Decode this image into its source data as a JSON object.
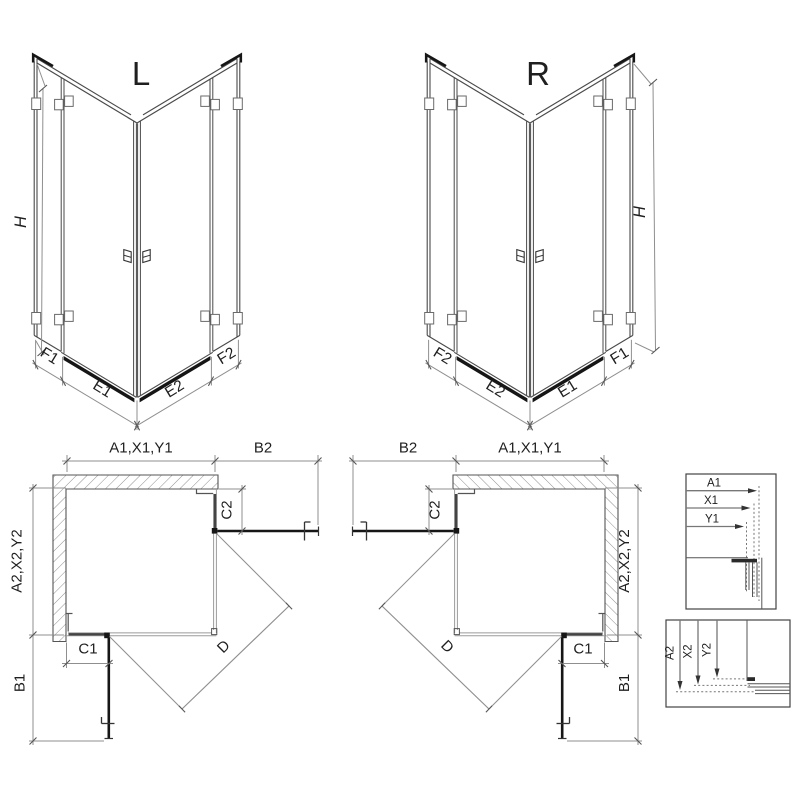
{
  "drawing": {
    "background": "#ffffff",
    "main_line_color": "#4a4a4a",
    "dim_line_color": "#8f8f8f",
    "dark_profile_color": "#161616"
  },
  "iso_left": {
    "title": "L",
    "height": "H",
    "panel_left": "F1",
    "door_left": "E1",
    "door_right": "E2",
    "panel_right": "F2"
  },
  "iso_right": {
    "title": "R",
    "height": "H",
    "panel_left": "F2",
    "door_left": "E2",
    "door_right": "E1",
    "panel_right": "F1"
  },
  "plan_left": {
    "width_top": "A1,X1,Y1",
    "door_open_side": "B2",
    "fixed_side": "C2",
    "depth_side": "A2,X2,Y2",
    "fixed_front": "C1",
    "door_open_front": "B1",
    "diagonal": "D"
  },
  "plan_right": {
    "width_top": "A1,X1,Y1",
    "door_open_side": "B2",
    "fixed_side": "C2",
    "depth_side": "A2,X2,Y2",
    "fixed_front": "C1",
    "door_open_front": "B1",
    "diagonal": "D"
  },
  "detail_width": {
    "rows": [
      {
        "label": "A1"
      },
      {
        "label": "X1"
      },
      {
        "label": "Y1"
      }
    ]
  },
  "detail_depth": {
    "rows": [
      {
        "label": "A2"
      },
      {
        "label": "X2"
      },
      {
        "label": "Y2"
      }
    ]
  }
}
